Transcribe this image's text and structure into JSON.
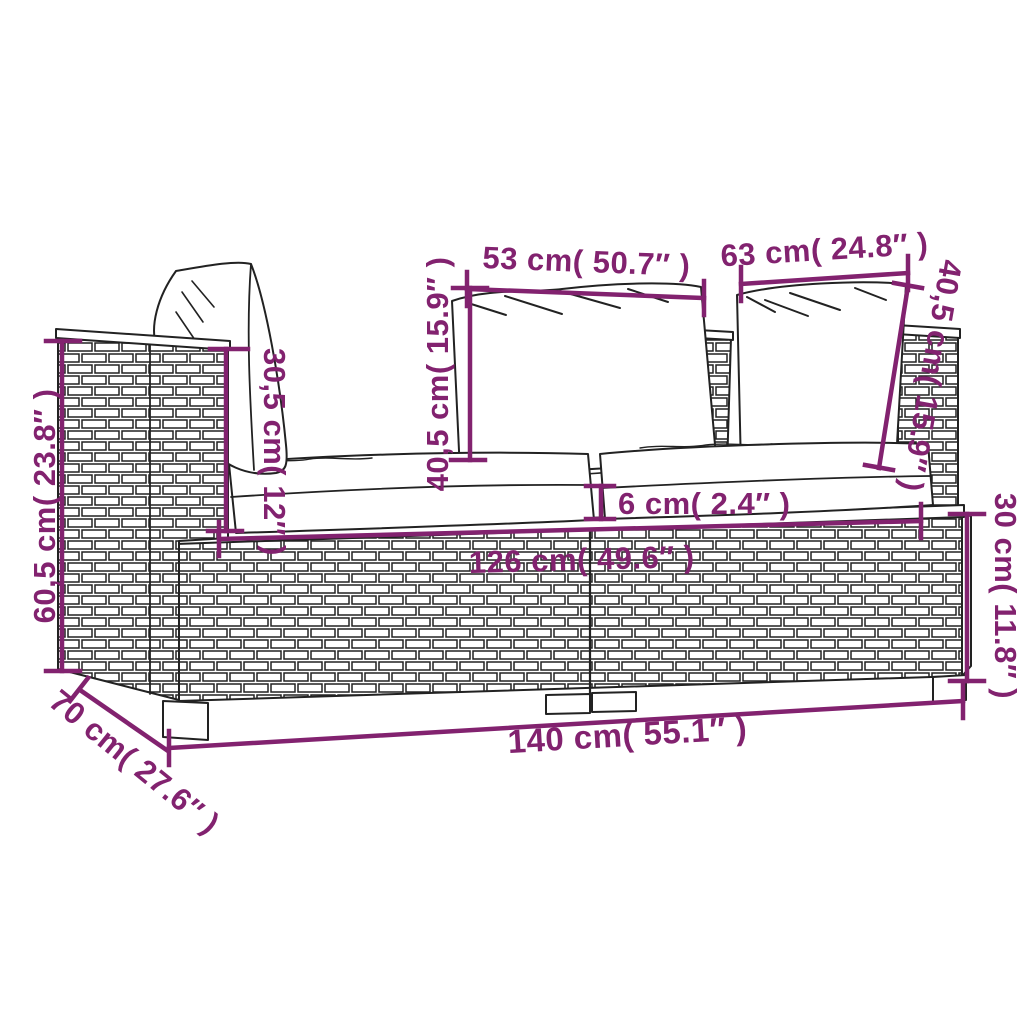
{
  "diagram": {
    "title": "2-seater poly rattan garden sofa dimension diagram",
    "accent_color": "#82226F",
    "line_color": "#222222",
    "background": "#ffffff"
  },
  "dims": {
    "pillow_small_width": {
      "label": "53 cm( 50.7″ )"
    },
    "pillow_large_width": {
      "label": "63 cm( 24.8″ )"
    },
    "total_height": {
      "label": "60,5 cm( 23.8″ )"
    },
    "armrest_height": {
      "label": "30,5 cm( 12″ )"
    },
    "back_height_mid": {
      "label": "40,5 cm( 15.9″ )"
    },
    "back_height_right": {
      "label": "40,5 cm( 15.9″ )"
    },
    "cushion_thickness": {
      "label": "6 cm( 2.4″ )"
    },
    "seat_width": {
      "label": "126 cm( 49.6″ )"
    },
    "base_height": {
      "label": "30 cm( 11.8″ )"
    },
    "total_width": {
      "label": "140 cm( 55.1″ )"
    },
    "total_depth": {
      "label": "70 cm( 27.6″ )"
    }
  }
}
